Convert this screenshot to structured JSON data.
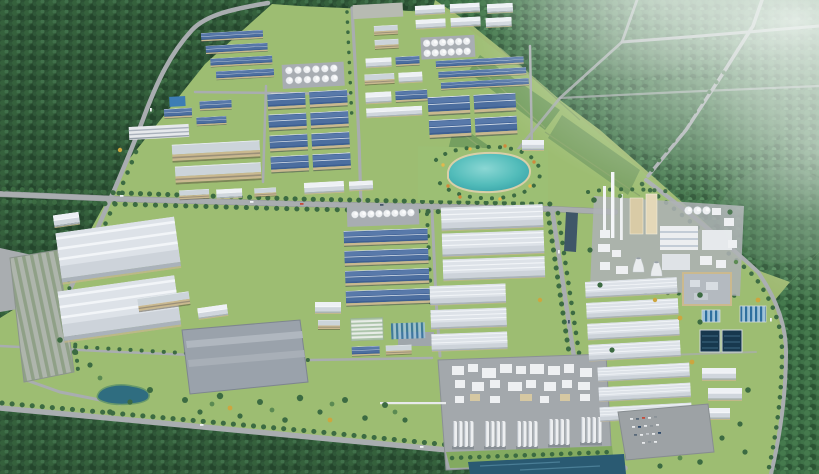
{
  "scene": {
    "type": "aerial-3d-architectural-render",
    "subject": "industrial park master plan in a green forested valley",
    "atmosphere": "white haze over forest in upper-right corner",
    "regions": [
      "forest-hills-top-left",
      "forest-hills-top-right-with-roads",
      "cleared-development-parcels-in-forest",
      "upper-industrial-zone-blue-and-white-roofs",
      "white-storage-tank-clusters",
      "large-blue-warehouse-grid",
      "central-lake-park-with-flower-beds",
      "mid-horizontal-boulevard-with-tree-lines",
      "lower-left-logistics-warehouses",
      "striped-parking-lot-far-left",
      "large-gray-flat-roof-warehouse",
      "small-landscape-pond",
      "central-blue-roof-factory-rows",
      "white-warehouse-complex-center",
      "chemical-tank-farm-with-column-groups",
      "water-channel-bottom-edge",
      "cement-plant-with-tall-stacks-and-cooling-towers",
      "white-warehouse-rows-right-block",
      "tan-admin-building-right",
      "water-treatment-basins-and-striped-clarifiers",
      "car-parking-lot-bottom-right",
      "perimeter-ring-road-right",
      "bottom-forest-belt"
    ]
  },
  "palette": {
    "grass": "#9db86f",
    "grass_light": "#a9c27f",
    "park_green": "#9cbf74",
    "forest_dark": "#2c5134",
    "forest_deep": "#24462c",
    "forest_mid": "#3a6a43",
    "forest_light": "#5b8a52",
    "parcel_line": "#87a46b",
    "road": "#a9adb0",
    "road_dark": "#8f9496",
    "roof_blue": "#3d5f92",
    "roof_blue_light": "#7b9ac8",
    "roof_white": "#dde2e8",
    "roof_white_hi": "#eef1f5",
    "roof_white_shade": "#c7cdd5",
    "roof_gray": "#9aa2ab",
    "wall_tan": "#c9b88f",
    "tank_white": "#eef0f2",
    "pad_gray": "#a8adb2",
    "lake_teal": "#3aa9ad",
    "lake_teal_light": "#8bd7d4",
    "pond_dark": "#2f6d80",
    "pool_navy": "#17384e",
    "water_channel": "#2a5a72",
    "haze_white": "#f0f6f2",
    "flower_yellow": "#e2b84d",
    "flower_orange": "#cf8a3c",
    "tree_green": "#3c6b42",
    "tree_yellow": "#cda63f"
  }
}
